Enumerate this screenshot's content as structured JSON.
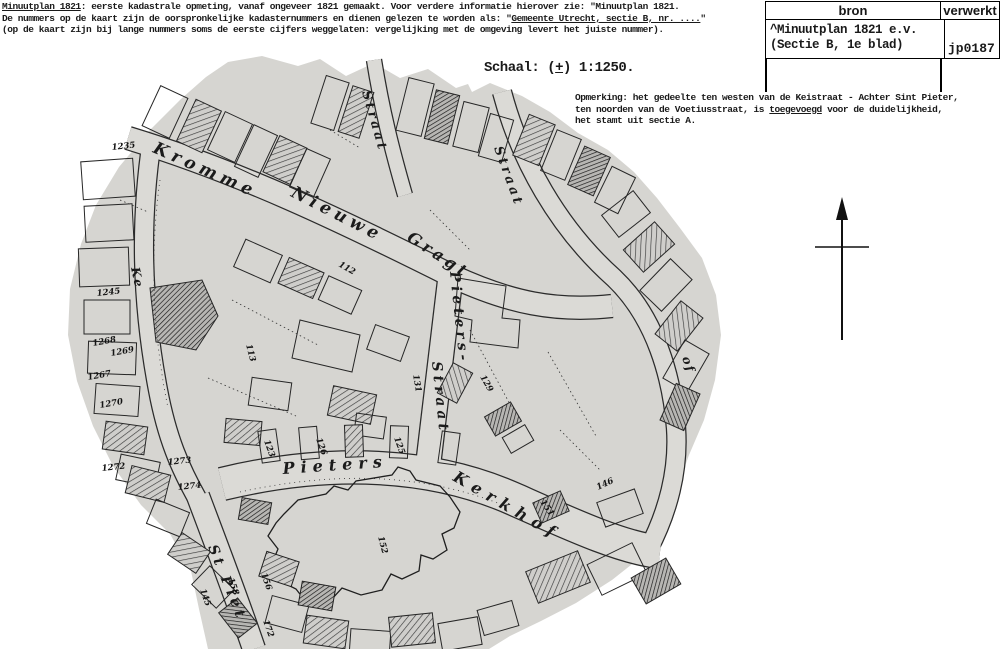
{
  "page": {
    "background": "#ffffff",
    "ink": "#1a1a1a",
    "map_paper": "#d6d5d1"
  },
  "header": {
    "line1_underlined": "Minuutplan 1821",
    "line1_rest": ": eerste kadastrale opmeting, vanaf ongeveer 1821 gemaakt. Voor verdere informatie hierover zie: \"Minuutplan 1821.",
    "line2_pre": "De nummers op de kaart zijn de oorspronkelijke kadasternummers en dienen gelezen te worden als: \"",
    "line2_underlined": "Gemeente Utrecht, sectie B, nr. ....",
    "line2_post": "\"",
    "line3": "(op de kaart zijn bij lange nummers soms de eerste cijfers weggelaten: vergelijking met de omgeving levert het juiste nummer)."
  },
  "scale": {
    "pre": "Schaal: (",
    "plusminus": "+",
    "post": ") 1:1250."
  },
  "remark": {
    "line1": "Opmerking: het gedeelte ten westen van de Keistraat - Achter Sint Pieter,",
    "line2_pre": "ten noorden van de Voetiusstraat, is ",
    "line2_underlined": "toegevoegd",
    "line2_post": " voor de duidelijkheid,",
    "line3": "het stamt uit sectie A."
  },
  "source_table": {
    "col1_header": "bron",
    "col2_header": "verwerkt",
    "source_line1": "^Minuutplan 1821 e.v.",
    "source_line2": "(Sectie B, 1e blad)",
    "processed": "jp0187"
  },
  "map": {
    "compass": "north-arrow",
    "street_labels": [
      {
        "id": "kromme",
        "text": "Kromme",
        "x": 152,
        "y": 152,
        "r": 24,
        "s": 17,
        "ls": 5
      },
      {
        "id": "nieuwe",
        "text": "Nieuwe",
        "x": 290,
        "y": 196,
        "r": 27,
        "s": 17,
        "ls": 5
      },
      {
        "id": "gragt",
        "text": "Gragt",
        "x": 406,
        "y": 240,
        "r": 33,
        "s": 16,
        "ls": 4
      },
      {
        "id": "straat-top",
        "text": "Straat",
        "x": 362,
        "y": 92,
        "r": 74,
        "s": 13,
        "ls": 3
      },
      {
        "id": "straat-right",
        "text": "Straat",
        "x": 494,
        "y": 148,
        "r": 70,
        "s": 13,
        "ls": 3
      },
      {
        "id": "pieters-mid",
        "text": "Pieters-",
        "x": 450,
        "y": 272,
        "r": 84,
        "s": 14,
        "ls": 4
      },
      {
        "id": "straat-mid",
        "text": "Straat",
        "x": 432,
        "y": 362,
        "r": 84,
        "s": 14,
        "ls": 4
      },
      {
        "id": "pieters-bottom",
        "text": "Pieters",
        "x": 283,
        "y": 474,
        "r": -4,
        "s": 16,
        "ls": 6
      },
      {
        "id": "kerkhof",
        "text": "Kerkhof",
        "x": 452,
        "y": 480,
        "r": 30,
        "s": 16,
        "ls": 7
      },
      {
        "id": "st-piet",
        "text": "St Piet",
        "x": 208,
        "y": 547,
        "r": 68,
        "s": 14,
        "ls": 4
      },
      {
        "id": "ke",
        "text": "Ke",
        "x": 131,
        "y": 268,
        "r": 78,
        "s": 12,
        "ls": 2
      },
      {
        "id": "of",
        "text": "of",
        "x": 682,
        "y": 358,
        "r": 70,
        "s": 12,
        "ls": 2
      }
    ],
    "parcel_numbers": [
      {
        "n": "1235",
        "x": 112,
        "y": 150,
        "r": -6
      },
      {
        "n": "1245",
        "x": 97,
        "y": 296,
        "r": -6
      },
      {
        "n": "1268",
        "x": 93,
        "y": 346,
        "r": -10
      },
      {
        "n": "1269",
        "x": 111,
        "y": 356,
        "r": -10
      },
      {
        "n": "1267",
        "x": 88,
        "y": 380,
        "r": -10
      },
      {
        "n": "1270",
        "x": 100,
        "y": 408,
        "r": -10
      },
      {
        "n": "1272",
        "x": 102,
        "y": 471,
        "r": -6
      },
      {
        "n": "1273",
        "x": 168,
        "y": 465,
        "r": -6
      },
      {
        "n": "1274",
        "x": 178,
        "y": 490,
        "r": -6
      },
      {
        "n": "113",
        "x": 246,
        "y": 345,
        "r": 75
      },
      {
        "n": "112",
        "x": 338,
        "y": 266,
        "r": 30
      },
      {
        "n": "131",
        "x": 413,
        "y": 375,
        "r": 80
      },
      {
        "n": "129",
        "x": 480,
        "y": 377,
        "r": 60
      },
      {
        "n": "123",
        "x": 264,
        "y": 441,
        "r": 70
      },
      {
        "n": "126",
        "x": 316,
        "y": 439,
        "r": 70
      },
      {
        "n": "125",
        "x": 394,
        "y": 438,
        "r": 70
      },
      {
        "n": "145",
        "x": 200,
        "y": 590,
        "r": 70
      },
      {
        "n": "158",
        "x": 228,
        "y": 579,
        "r": 70
      },
      {
        "n": "156",
        "x": 261,
        "y": 574,
        "r": 70
      },
      {
        "n": "172",
        "x": 263,
        "y": 621,
        "r": 70
      },
      {
        "n": "152",
        "x": 378,
        "y": 537,
        "r": 75
      },
      {
        "n": "151",
        "x": 540,
        "y": 502,
        "r": 55
      },
      {
        "n": "146",
        "x": 598,
        "y": 490,
        "r": -25
      }
    ]
  }
}
